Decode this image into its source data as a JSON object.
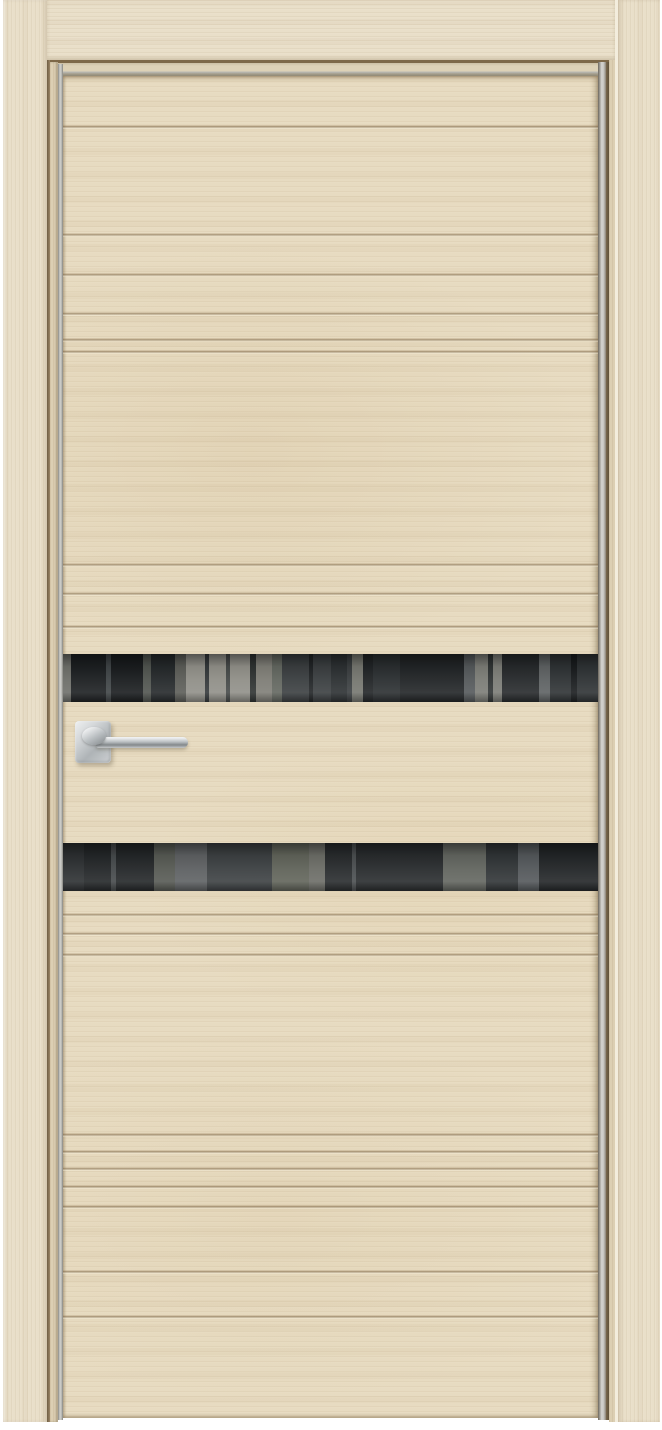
{
  "scene": {
    "type": "product-photo",
    "subject": "Modern interior door, closed, front view on white background",
    "background_color": "#ffffff"
  },
  "door": {
    "finish": "light oak veneer with horizontal milled grooves",
    "leaf_style": "two full-width black tinted glass strips with room reflections, aluminum edge trim, wood casing frame",
    "handle": {
      "type": "lever on square rose",
      "finish": "polished chrome",
      "side": "left",
      "height": "mid-door between glass strips"
    },
    "colors": {
      "wood_base": "#e7dbc1",
      "wood_casing": "#e9dfc9",
      "wood_jamb": "#dccfb3",
      "groove_dark": "#8d7350",
      "groove_light": "#f7f0dd",
      "frame_seam": "#7d6848",
      "aluminum_edge": "#cfcfcb",
      "aluminum_edge_dark": "#8a8a84",
      "glass_base": "#34383a",
      "glass_dark": "#1a1d1f",
      "glass_light": "#8f8e87",
      "chrome_light": "#eef0f1",
      "chrome_mid": "#b9bec1",
      "chrome_dark": "#83888b",
      "background": "#ffffff"
    },
    "leaf_top": 76,
    "grooves_top_y": [
      125,
      233,
      273,
      312,
      338,
      350,
      563,
      592,
      625
    ],
    "grooves_bottom_y": [
      913,
      932,
      953,
      1133,
      1150,
      1167,
      1185,
      1205,
      1270,
      1315
    ],
    "glass_strips": [
      {
        "name": "upper",
        "top": 654,
        "height": 48,
        "streaks": [
          {
            "x": 0,
            "w": 1.5,
            "c": "#6d6e69"
          },
          {
            "x": 1.5,
            "w": 6.5,
            "c": "#1c1f21"
          },
          {
            "x": 8,
            "w": 1,
            "c": "#3f4446"
          },
          {
            "x": 9,
            "w": 6,
            "c": "#191c1e"
          },
          {
            "x": 15,
            "w": 1.5,
            "c": "#50544f"
          },
          {
            "x": 16.5,
            "w": 4.5,
            "c": "#24282a"
          },
          {
            "x": 21,
            "w": 2,
            "c": "#5b5c57"
          },
          {
            "x": 23,
            "w": 16,
            "c": "#908f88"
          },
          {
            "x": 26.5,
            "w": 0.8,
            "c": "#34383a"
          },
          {
            "x": 30.5,
            "w": 0.8,
            "c": "#454948"
          },
          {
            "x": 35,
            "w": 1,
            "c": "#2e3231"
          },
          {
            "x": 36,
            "w": 3,
            "c": "#7e7d76"
          },
          {
            "x": 39,
            "w": 2,
            "c": "#62665f"
          },
          {
            "x": 41,
            "w": 13,
            "c": "#3a3e40"
          },
          {
            "x": 46,
            "w": 0.8,
            "c": "#212426"
          },
          {
            "x": 50,
            "w": 3,
            "c": "#2c3032"
          },
          {
            "x": 54,
            "w": 2,
            "c": "#75766f"
          },
          {
            "x": 56,
            "w": 19,
            "c": "#212426"
          },
          {
            "x": 58,
            "w": 5,
            "c": "#2a2e30"
          },
          {
            "x": 75,
            "w": 2,
            "c": "#54585a"
          },
          {
            "x": 77,
            "w": 5,
            "c": "#7b7c76"
          },
          {
            "x": 79.5,
            "w": 0.8,
            "c": "#303434"
          },
          {
            "x": 82,
            "w": 7,
            "c": "#26292b"
          },
          {
            "x": 89,
            "w": 2,
            "c": "#5d6162"
          },
          {
            "x": 91,
            "w": 9,
            "c": "#2e3234"
          },
          {
            "x": 95,
            "w": 1,
            "c": "#191c1e"
          }
        ]
      },
      {
        "name": "lower",
        "top": 843,
        "height": 48,
        "streaks": [
          {
            "x": 0,
            "w": 4,
            "c": "#2c2f31"
          },
          {
            "x": 4,
            "w": 13,
            "c": "#232628"
          },
          {
            "x": 9,
            "w": 1,
            "c": "#45494b"
          },
          {
            "x": 17,
            "w": 4,
            "c": "#565953"
          },
          {
            "x": 21,
            "w": 6,
            "c": "#5d6062"
          },
          {
            "x": 27,
            "w": 12,
            "c": "#3c4042"
          },
          {
            "x": 39,
            "w": 7,
            "c": "#606359"
          },
          {
            "x": 46,
            "w": 3,
            "c": "#6b6c66"
          },
          {
            "x": 49,
            "w": 22,
            "c": "#282b2d"
          },
          {
            "x": 54,
            "w": 0.8,
            "c": "#4a4e50"
          },
          {
            "x": 71,
            "w": 8,
            "c": "#62655f"
          },
          {
            "x": 79,
            "w": 6,
            "c": "#303436"
          },
          {
            "x": 85,
            "w": 4,
            "c": "#53575a"
          },
          {
            "x": 89,
            "w": 11,
            "c": "#222527"
          }
        ]
      }
    ]
  }
}
